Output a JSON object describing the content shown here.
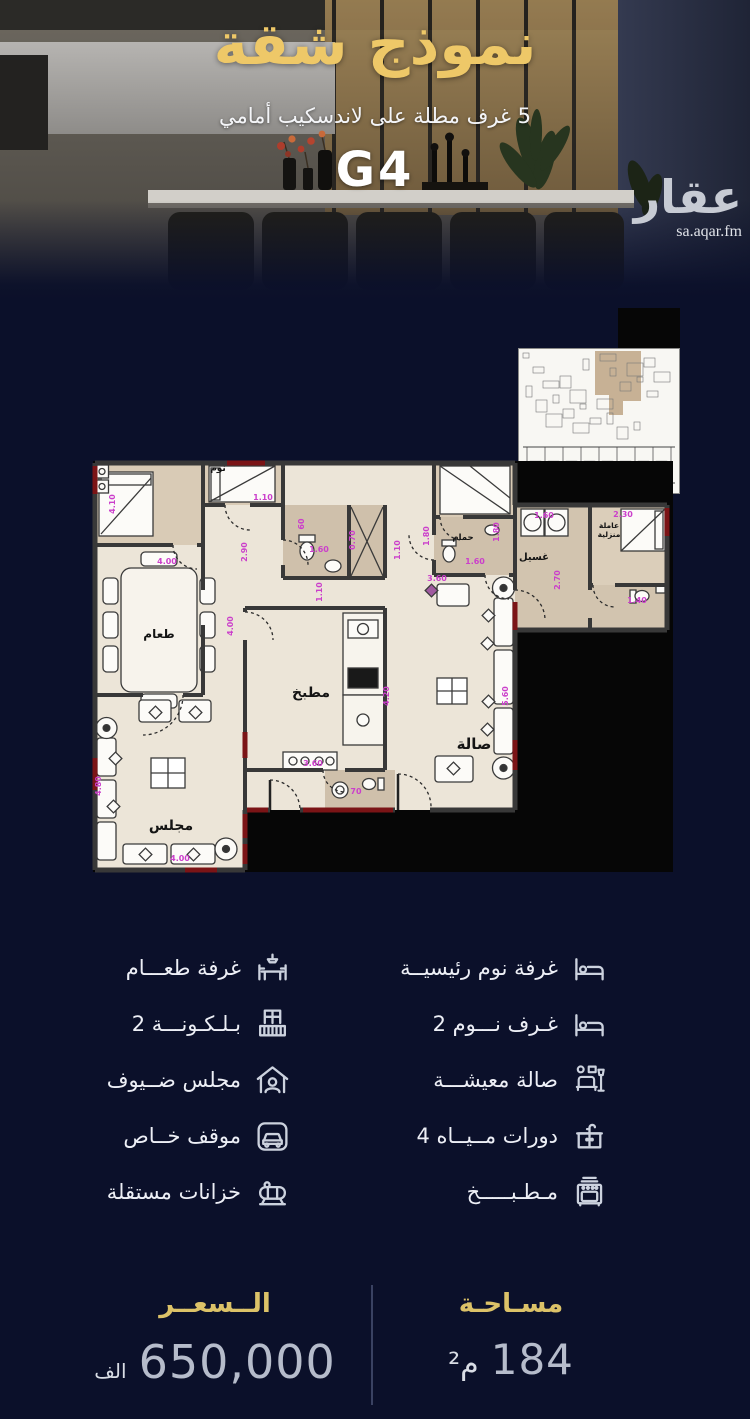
{
  "hero": {
    "title": "نموذج شقة",
    "subtitle": "5 غرف مطلة على لاندسكيب أمامي",
    "unit_code": "G4",
    "brand": {
      "name": "عقار",
      "site": "sa.aqar.fm"
    }
  },
  "floor_plan": {
    "room_labels": [
      {
        "text": "نوم",
        "x": 133,
        "y": 31,
        "s": 9
      },
      {
        "text": "طعام",
        "x": 74,
        "y": 198,
        "s": 12
      },
      {
        "text": "مجلس",
        "x": 86,
        "y": 390,
        "s": 14
      },
      {
        "text": "مطبخ",
        "x": 226,
        "y": 257,
        "s": 14
      },
      {
        "text": "صالة",
        "x": 389,
        "y": 309,
        "s": 15
      },
      {
        "text": "حمام",
        "x": 378,
        "y": 100,
        "s": 8.5
      },
      {
        "text": "غسيل",
        "x": 449,
        "y": 120,
        "s": 10
      },
      {
        "text": "عاملة",
        "x": 524,
        "y": 88,
        "s": 7.5
      },
      {
        "text": "منزلية",
        "x": 524,
        "y": 97,
        "s": 7.5
      }
    ],
    "dimensions": [
      {
        "text": "4.10",
        "x": 30,
        "y": 64,
        "r": true
      },
      {
        "text": "1.10",
        "x": 178,
        "y": 60
      },
      {
        "text": "4.00",
        "x": 82,
        "y": 124
      },
      {
        "text": "2.90",
        "x": 162,
        "y": 112,
        "r": true
      },
      {
        "text": "60",
        "x": 219,
        "y": 84,
        "r": true,
        "s": 6.5
      },
      {
        "text": "1.60",
        "x": 234,
        "y": 112
      },
      {
        "text": "0.70",
        "x": 270,
        "y": 100,
        "r": true
      },
      {
        "text": "1.10",
        "x": 237,
        "y": 152,
        "r": true
      },
      {
        "text": "1.10",
        "x": 315,
        "y": 110,
        "r": true
      },
      {
        "text": "1.80",
        "x": 344,
        "y": 96,
        "r": true
      },
      {
        "text": "1.80",
        "x": 414,
        "y": 92,
        "r": true
      },
      {
        "text": "1.60",
        "x": 390,
        "y": 124
      },
      {
        "text": "1.60",
        "x": 459,
        "y": 78,
        "s": 7
      },
      {
        "text": "2.70",
        "x": 475,
        "y": 140,
        "r": true
      },
      {
        "text": "2.30",
        "x": 538,
        "y": 77
      },
      {
        "text": "1.40",
        "x": 552,
        "y": 163,
        "s": 7
      },
      {
        "text": "4.00",
        "x": 148,
        "y": 186,
        "r": true
      },
      {
        "text": "4.20",
        "x": 304,
        "y": 256,
        "r": true
      },
      {
        "text": "3.60",
        "x": 228,
        "y": 326
      },
      {
        "text": "5.60",
        "x": 423,
        "y": 256,
        "r": true
      },
      {
        "text": "3.60",
        "x": 352,
        "y": 141,
        "s": 7
      },
      {
        "text": "4.80",
        "x": 16,
        "y": 346,
        "r": true
      },
      {
        "text": "4.00",
        "x": 95,
        "y": 421
      },
      {
        "text": "70",
        "x": 271,
        "y": 354,
        "s": 7
      }
    ]
  },
  "features": {
    "left": [
      {
        "label": "غرفة طعـــام",
        "icon": "dining-table-icon"
      },
      {
        "label": "بـلـكـونـــة 2",
        "icon": "balcony-icon"
      },
      {
        "label": "مجلس ضــيوف",
        "icon": "guest-house-icon"
      },
      {
        "label": "موقف خــاص",
        "icon": "car-icon"
      },
      {
        "label": "خزانات مستقلة",
        "icon": "water-tank-icon"
      }
    ],
    "right": [
      {
        "label": "غرفة نوم رئيسيــة",
        "icon": "bed-icon"
      },
      {
        "label": "غـرف نـــوم 2",
        "icon": "bed-icon"
      },
      {
        "label": "صالة معيشـــة",
        "icon": "living-room-icon"
      },
      {
        "label": "دورات مــيــاه 4",
        "icon": "bathroom-sink-icon"
      },
      {
        "label": "مـطـبـــــخ",
        "icon": "kitchen-stove-icon"
      }
    ]
  },
  "stats": {
    "price": {
      "label": "الــسعــر",
      "value": "650,000",
      "unit": "الف"
    },
    "area": {
      "label": "مسـاحـة",
      "value": "184",
      "unit": "م²"
    }
  },
  "colors": {
    "navy": "#0b102a",
    "gold": "#eec868",
    "magenta": "#cb3fcb",
    "wall": "#383838",
    "floor": "#ece5d8",
    "wet_floor": "#cfc0ab",
    "accent_red": "#7b1416",
    "value_gray": "#b6bccb"
  }
}
